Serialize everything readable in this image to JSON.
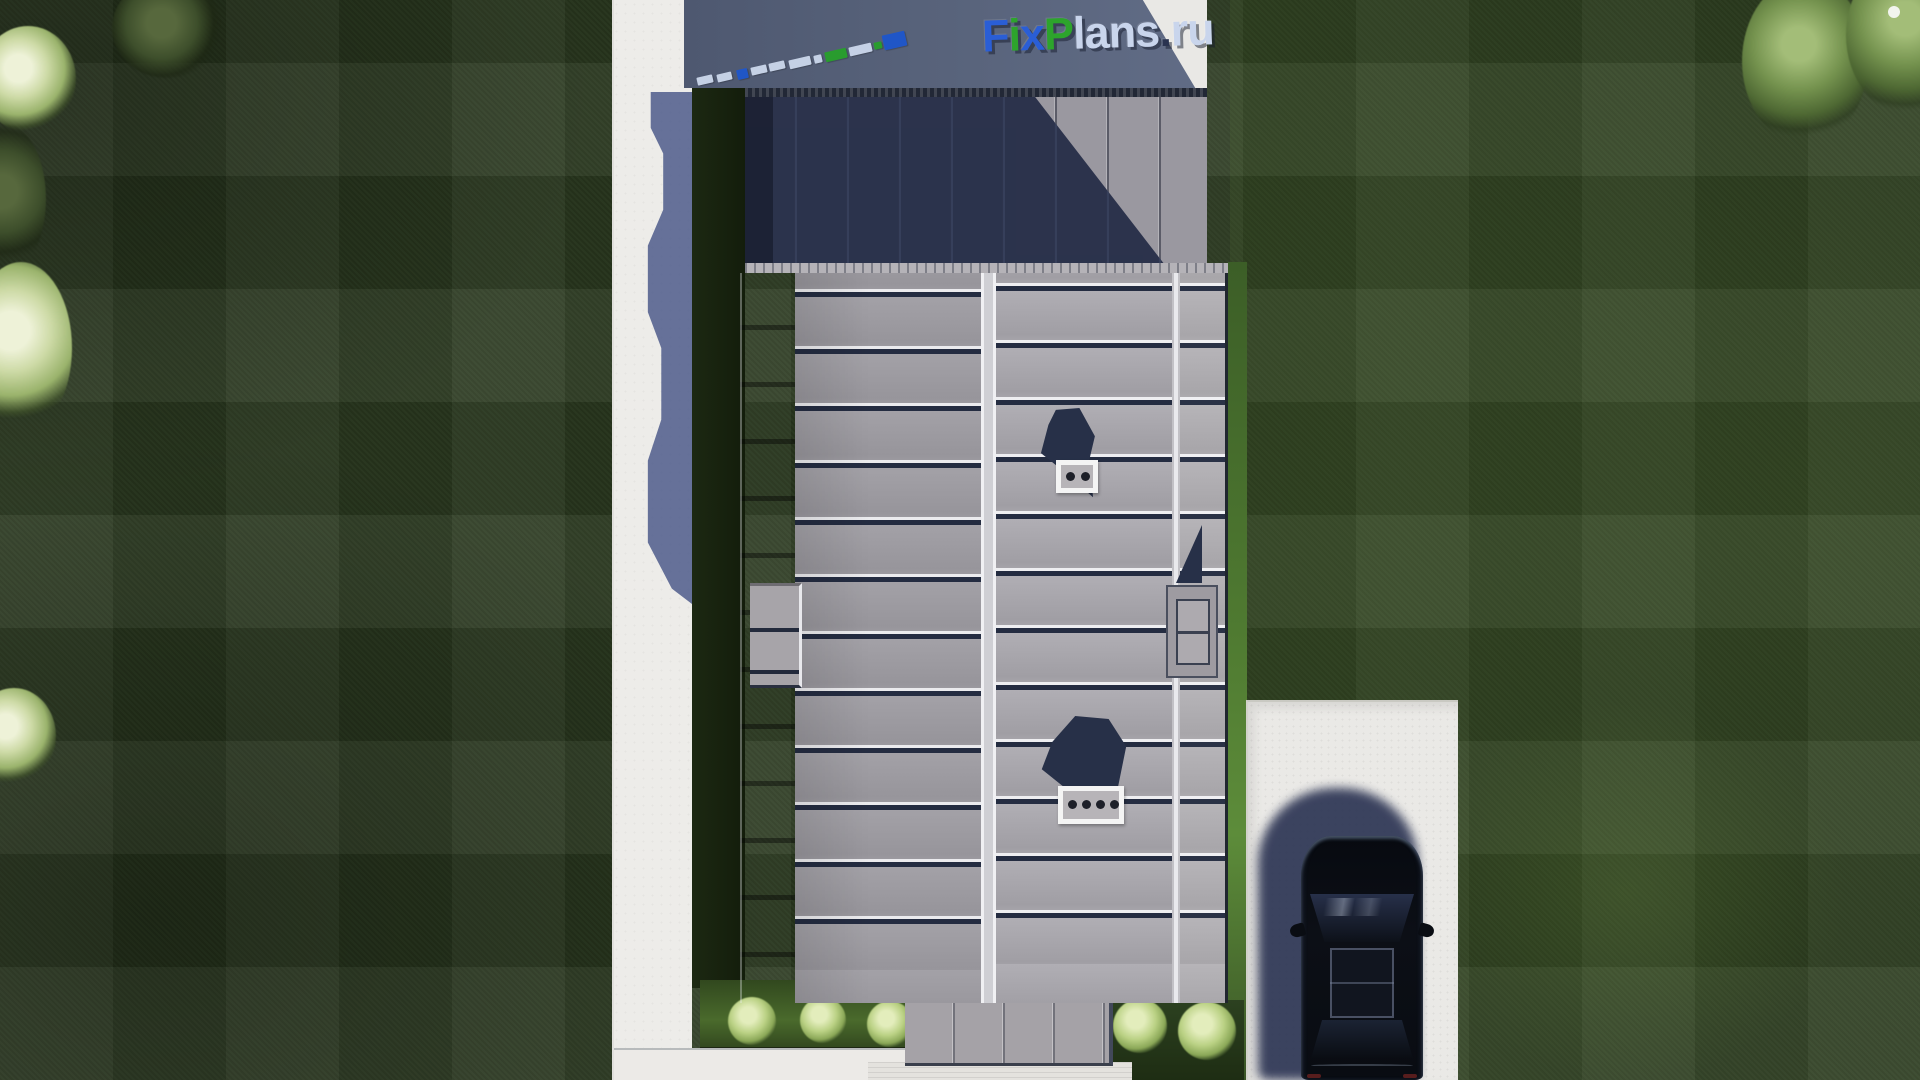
{
  "logo": {
    "alt": "FixPlans.ru",
    "parts": [
      {
        "text": "F",
        "color_key": "blue"
      },
      {
        "text": "i",
        "color_key": "green"
      },
      {
        "text": "x",
        "color_key": "blue"
      },
      {
        "text": "P",
        "color_key": "green"
      },
      {
        "text": "lans",
        "color_key": "pale"
      },
      {
        "text": ".",
        "color_key": "dark"
      },
      {
        "text": "ru",
        "color_key": "pale"
      }
    ]
  },
  "colors": {
    "logo": {
      "blue": "#2a5ed6",
      "green": "#2da42c",
      "pale": "#c9d5ec",
      "dark": "#2a3350"
    },
    "watermark_tiles": {
      "pale": "#ccd8ec",
      "blue": "#1e56cc",
      "green": "#27a02b"
    },
    "grass_base": "#2b3a20",
    "roof_panel": "#a3a1a7",
    "roof_shadow": "#262e48",
    "concrete": "#edece9",
    "car_body": "#0c0f16"
  },
  "scene": {
    "watermark_tiles": [
      {
        "x": 697,
        "y": 76,
        "w": 16,
        "h": 8,
        "c": "pale"
      },
      {
        "x": 717,
        "y": 73,
        "w": 15,
        "h": 8,
        "c": "pale"
      },
      {
        "x": 737,
        "y": 69,
        "w": 11,
        "h": 10,
        "c": "blue"
      },
      {
        "x": 751,
        "y": 66,
        "w": 16,
        "h": 8,
        "c": "pale"
      },
      {
        "x": 769,
        "y": 62,
        "w": 16,
        "h": 8,
        "c": "pale"
      },
      {
        "x": 789,
        "y": 58,
        "w": 22,
        "h": 9,
        "c": "pale"
      },
      {
        "x": 814,
        "y": 55,
        "w": 8,
        "h": 8,
        "c": "pale"
      },
      {
        "x": 825,
        "y": 50,
        "w": 22,
        "h": 10,
        "c": "green"
      },
      {
        "x": 849,
        "y": 45,
        "w": 23,
        "h": 9,
        "c": "pale"
      },
      {
        "x": 874,
        "y": 42,
        "w": 8,
        "h": 7,
        "c": "green"
      },
      {
        "x": 883,
        "y": 33,
        "w": 23,
        "h": 15,
        "c": "blue"
      }
    ],
    "trees": [
      {
        "cls": "dark",
        "x": 112,
        "y": -22,
        "w": 110,
        "h": 100
      },
      {
        "cls": "bright",
        "x": -20,
        "y": 26,
        "w": 96,
        "h": 106
      },
      {
        "cls": "dark",
        "x": -36,
        "y": 124,
        "w": 82,
        "h": 150
      },
      {
        "cls": "bright",
        "x": -30,
        "y": 262,
        "w": 102,
        "h": 172
      },
      {
        "cls": "bright",
        "x": -28,
        "y": 688,
        "w": 84,
        "h": 96
      },
      {
        "cls": "mid",
        "x": 1742,
        "y": -22,
        "w": 126,
        "h": 166
      },
      {
        "cls": "mid",
        "x": 1846,
        "y": -46,
        "w": 132,
        "h": 162
      },
      {
        "cls": "speck",
        "x": 1888,
        "y": 6,
        "w": 12,
        "h": 12
      }
    ],
    "bushes": [
      {
        "x": 752,
        "y": 1021,
        "r": 24
      },
      {
        "x": 823,
        "y": 1020,
        "r": 23
      },
      {
        "x": 890,
        "y": 1024,
        "r": 23
      },
      {
        "x": 1140,
        "y": 1026,
        "r": 27
      },
      {
        "x": 1207,
        "y": 1031,
        "r": 29
      }
    ]
  }
}
